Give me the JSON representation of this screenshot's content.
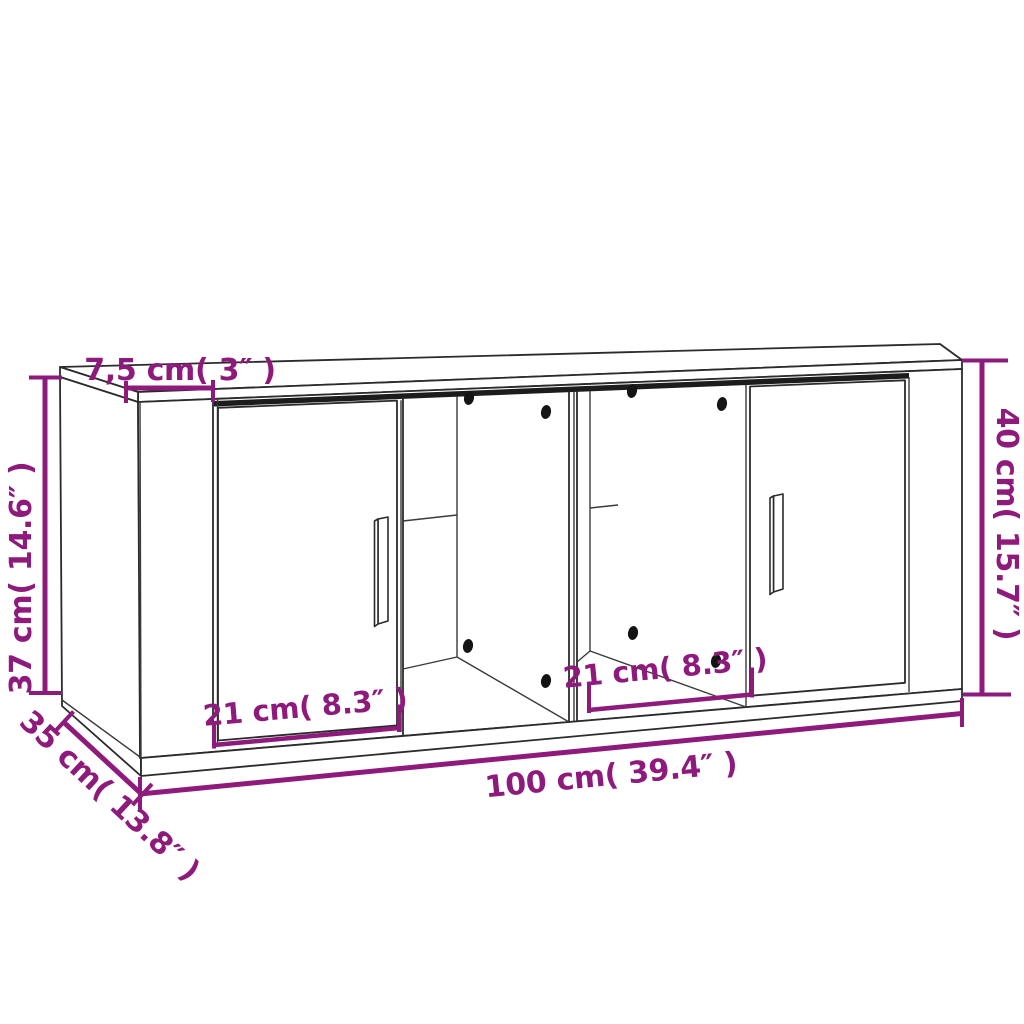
{
  "diagram": {
    "kind": "furniture-dimension-diagram",
    "colors": {
      "dimension_accent": "#8E1A7C",
      "line_art": "#2b2b2b",
      "background": "#ffffff"
    },
    "dimensions": {
      "top_thickness": {
        "label": "7,5 cm( 3″ )",
        "cm": "7,5",
        "inch": "3"
      },
      "left_height": {
        "label": "37 cm( 14.6″ )",
        "cm": "37",
        "inch": "14.6"
      },
      "right_height": {
        "label": "40 cm( 15.7″ )",
        "cm": "40",
        "inch": "15.7"
      },
      "depth": {
        "label": "35 cm( 13.8″ )",
        "cm": "35",
        "inch": "13.8"
      },
      "left_compartment_width": {
        "label": "21 cm( 8.3″ )",
        "cm": "21",
        "inch": "8.3"
      },
      "right_compartment_width": {
        "label": "21 cm( 8.3″ )",
        "cm": "21",
        "inch": "8.3"
      },
      "total_width": {
        "label": "100 cm( 39.4″ )",
        "cm": "100",
        "inch": "39.4"
      }
    }
  }
}
